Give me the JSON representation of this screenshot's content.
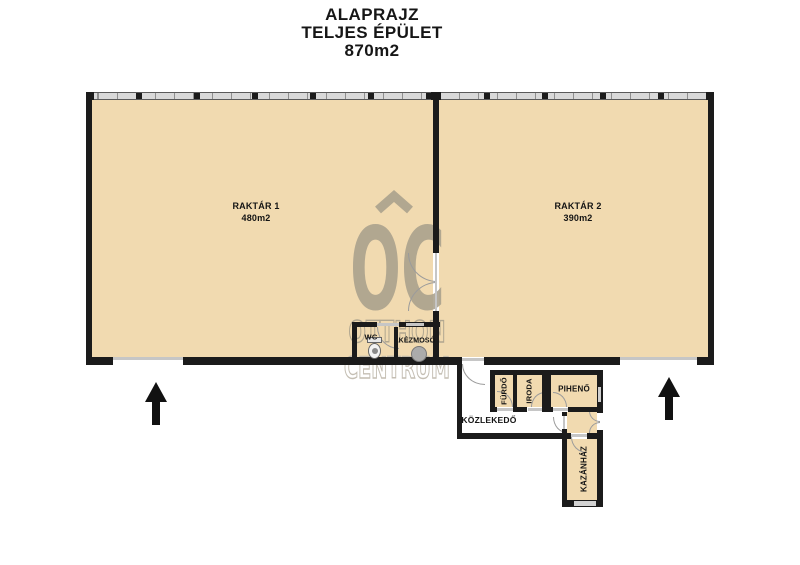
{
  "title": {
    "line1": "ALAPRAJZ",
    "line2": "TELJES ÉPÜLET",
    "line3": "870m2"
  },
  "watermark": {
    "initials": "OC",
    "line1": "OTTHON",
    "line2": "CENTRUM"
  },
  "rooms": {
    "raktar1": {
      "name": "RAKTÁR 1",
      "area": "480m2"
    },
    "raktar2": {
      "name": "RAKTÁR 2",
      "area": "390m2"
    },
    "wc": {
      "name": "WC"
    },
    "kezmoso": {
      "name": "KÉZMOSÓ"
    },
    "furdo": {
      "name": "FÜRDŐ"
    },
    "iroda": {
      "name": "IRODA"
    },
    "piheno": {
      "name": "PIHENŐ"
    },
    "kozlekedo": {
      "name": "KÖZLEKEDŐ"
    },
    "kazanhaz": {
      "name": "KAZÁNHÁZ"
    }
  },
  "colors": {
    "room_fill": "#f1dab0",
    "wall": "#1b1b1b",
    "watermark": "#a9a08c",
    "watermark_light": "#bcb6a9",
    "window_band": "#d9d9d9",
    "door_arc": "#9b9b9b",
    "opening": "#c6c6c6",
    "arrow": "#111111"
  }
}
